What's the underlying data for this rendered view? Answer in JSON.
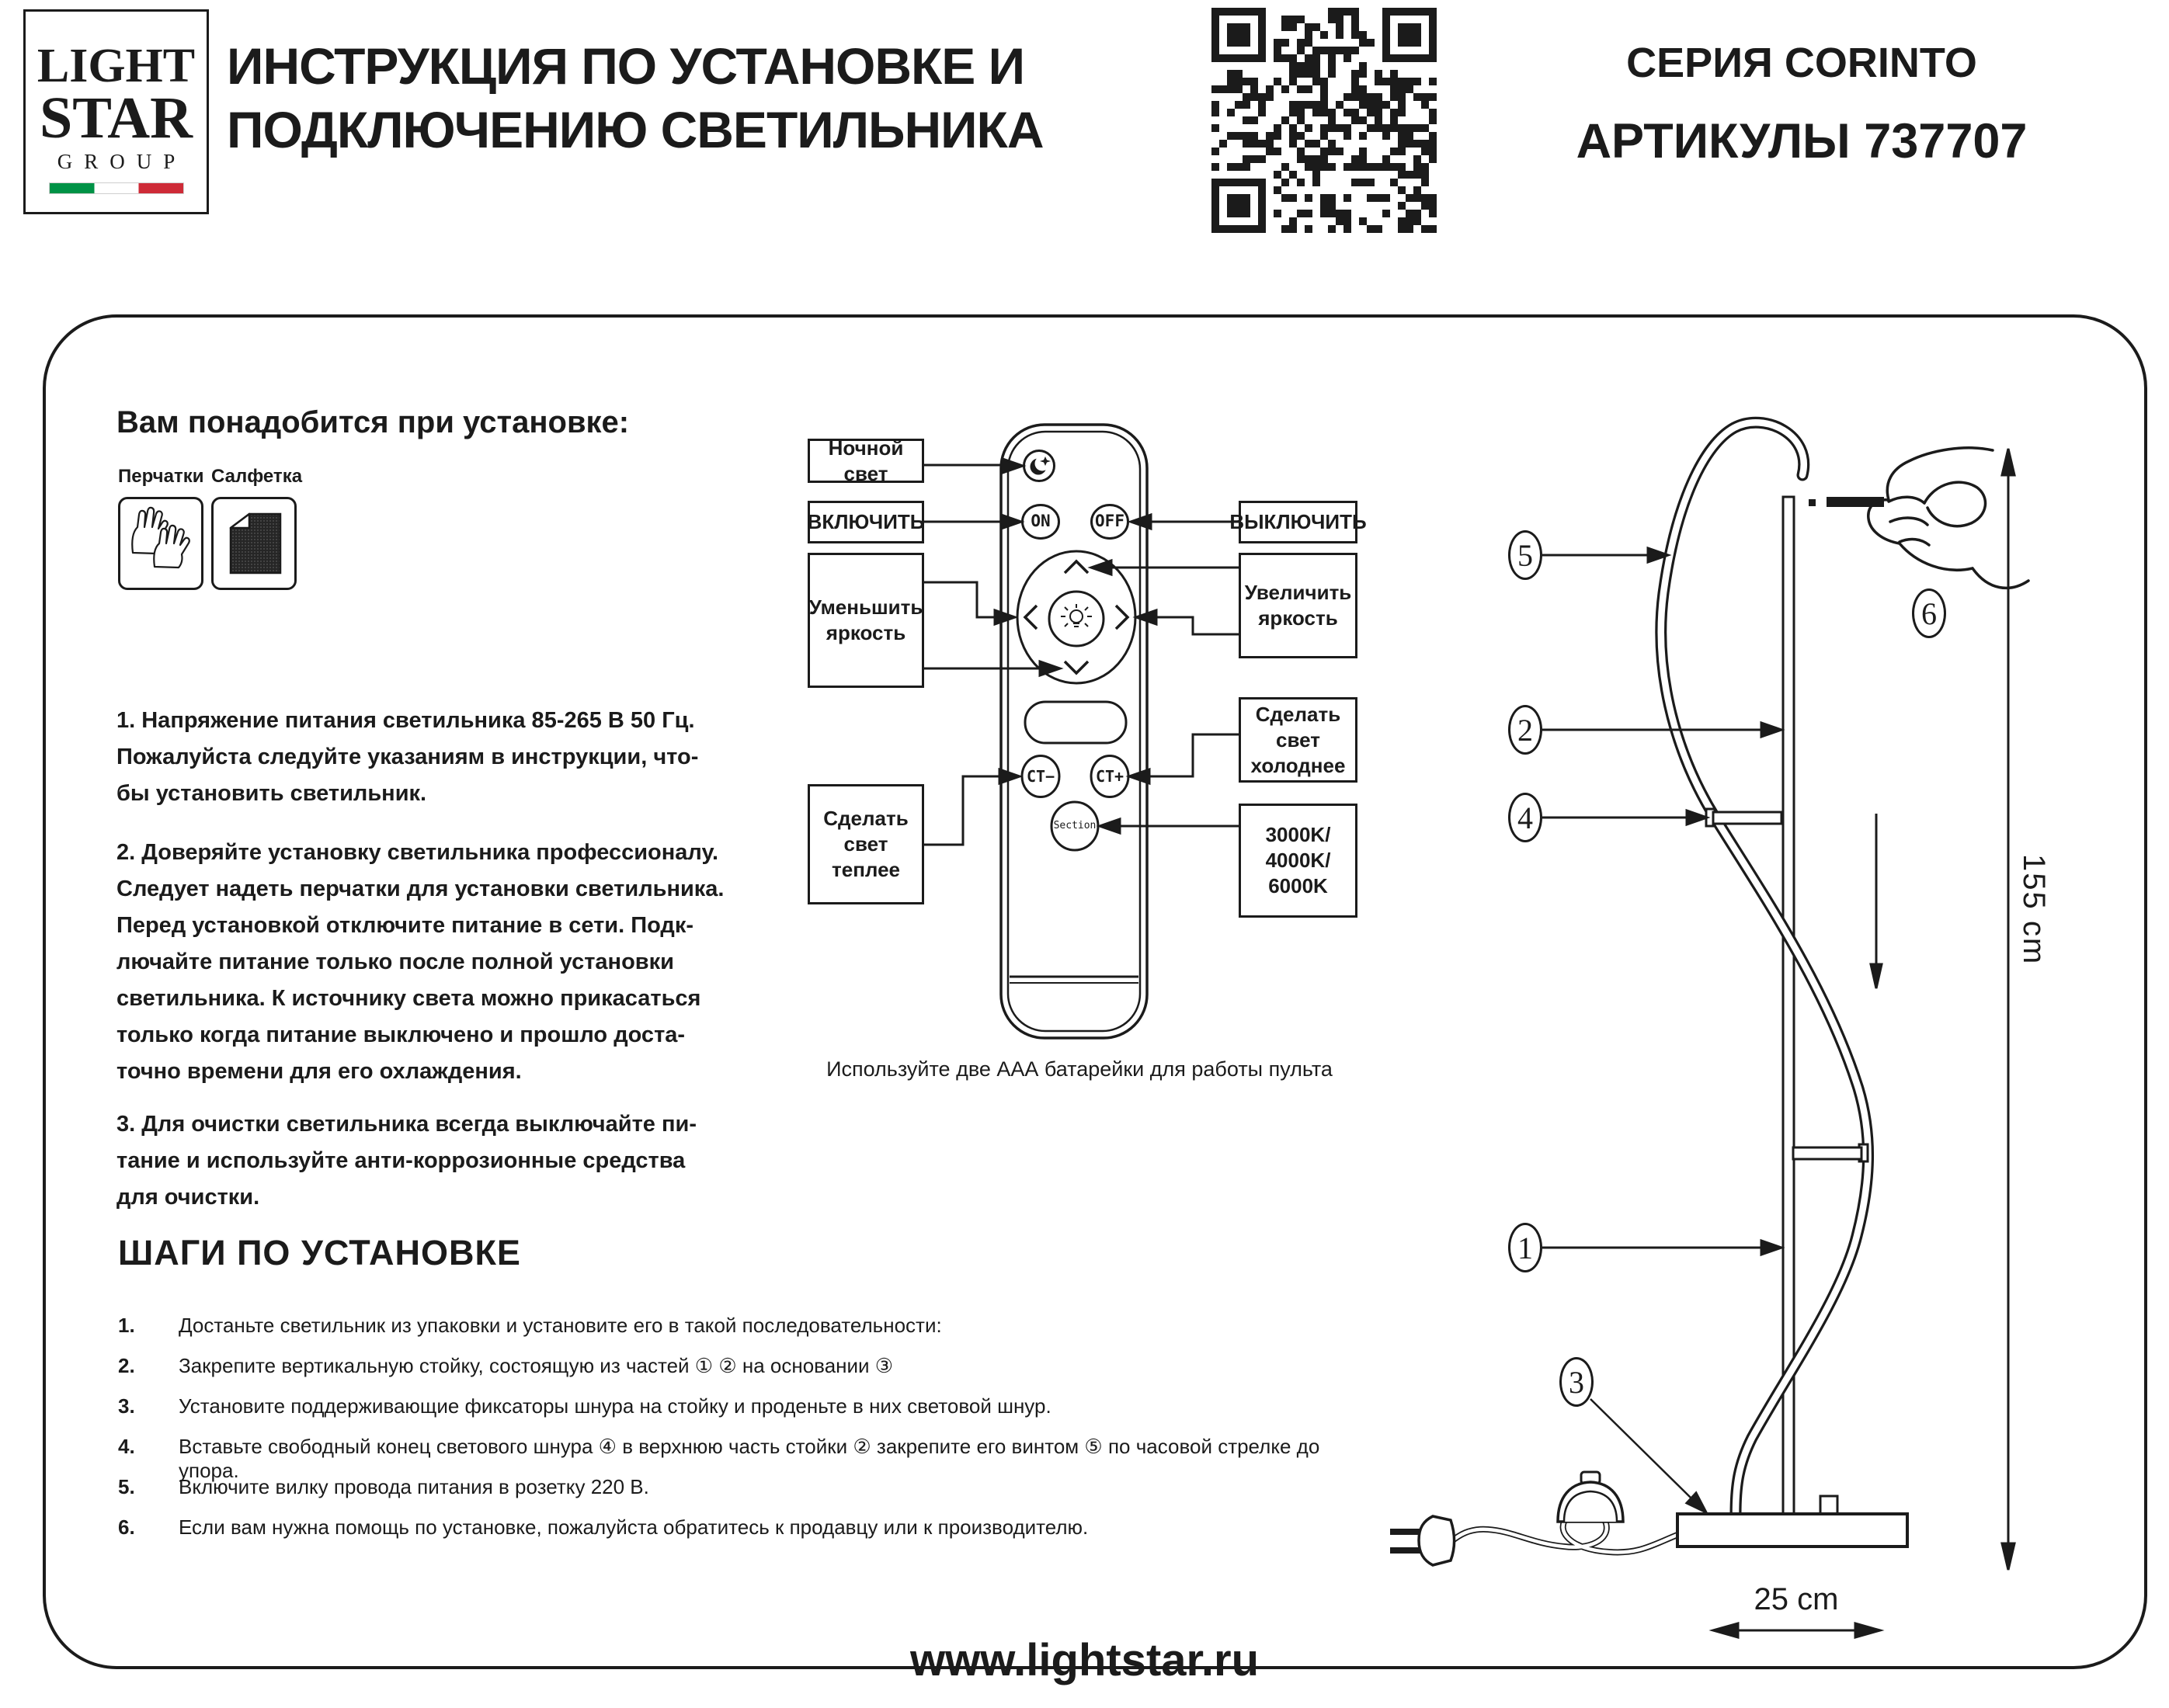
{
  "header": {
    "logo": {
      "line1": "LIGHT",
      "line2": "STAR",
      "line3": "GROUP"
    },
    "title": "ИНСТРУКЦИЯ ПО УСТАНОВКЕ И\nПОДКЛЮЧЕНИЮ СВЕТИЛЬНИКА",
    "series": "СЕРИЯ CORINTO",
    "article": "АРТИКУЛЫ 737707"
  },
  "needs": {
    "heading": "Вам понадобится при установке:",
    "item1": {
      "label": "Перчатки",
      "icon": "gloves-icon"
    },
    "item2": {
      "label": "Салфетка",
      "icon": "napkin-icon"
    }
  },
  "paragraphs": {
    "p1": "1. Напряжение питания светильника 85-265 В 50 Гц.\nПожалуйста следуйте указаниям в инструкции, что-\nбы установить светильник.",
    "p2": "2. Доверяйте установку светильника профессионалу.\nСледует надеть перчатки для установки светильника.\nПеред установкой отключите питание в сети. Подк-\nлючайте питание только после полной установки\nсветильника. К источнику света можно прикасаться\nтолько когда питание выключено и прошло доста-\nточно времени для его охлаждения.",
    "p3": "3. Для очистки светильника всегда выключайте пи-\nтание и используйте анти-коррозионные средства\nдля очистки."
  },
  "remote": {
    "buttons": {
      "night_icon": "moon-star-icon",
      "on": "ON",
      "off": "OFF",
      "brightness_icon": "bulb-icon",
      "ct_minus": "CT−",
      "ct_plus": "CT+",
      "section": "Section"
    },
    "labels": {
      "night": "Ночной свет",
      "turn_on": "ВКЛЮЧИТЬ",
      "turn_off": "ВЫКЛЮЧИТЬ",
      "decrease": "Уменьшить\nяркость",
      "increase": "Увеличить\nяркость",
      "warmer": "Сделать\nсвет\nтеплее",
      "colder": "Сделать\nсвет\nхолоднее",
      "kelvin": "3000K/\n4000K/\n6000K"
    },
    "caption": "Используйте две ААА батарейки для работы пульта"
  },
  "steps": {
    "heading": "ШАГИ ПО УСТАНОВКЕ",
    "items": [
      {
        "num": "1.",
        "text": "Достаньте светильник из упаковки и установите его в такой последовательности:"
      },
      {
        "num": "2.",
        "text": "Закрепите вертикальную стойку, состоящую из частей ①   ②   на основании ③"
      },
      {
        "num": "3.",
        "text": "Установите поддерживающие фиксаторы шнура на стойку и проденьте в них световой шнур."
      },
      {
        "num": "4.",
        "text": "Вставьте свободный конец светового шнура ④ в верхнюю часть стойки ②  закрепите его винтом ⑤ по часовой стрелке до упора."
      },
      {
        "num": "5.",
        "text": "Включите вилку провода питания в розетку 220 В."
      },
      {
        "num": "6.",
        "text": "Если вам нужна помощь по установке, пожалуйста обратитесь к продавцу или к производителю."
      }
    ]
  },
  "diagram": {
    "callouts": {
      "c1": "1",
      "c2": "2",
      "c3": "3",
      "c4": "4",
      "c5": "5",
      "c6": "6"
    },
    "height_dim": "155 cm",
    "base_dim": "25 cm"
  },
  "footer": {
    "site": "www.lightstar.ru"
  },
  "colors": {
    "ink": "#1b1b1b",
    "flag_green": "#009246",
    "flag_red": "#ce2b37"
  }
}
